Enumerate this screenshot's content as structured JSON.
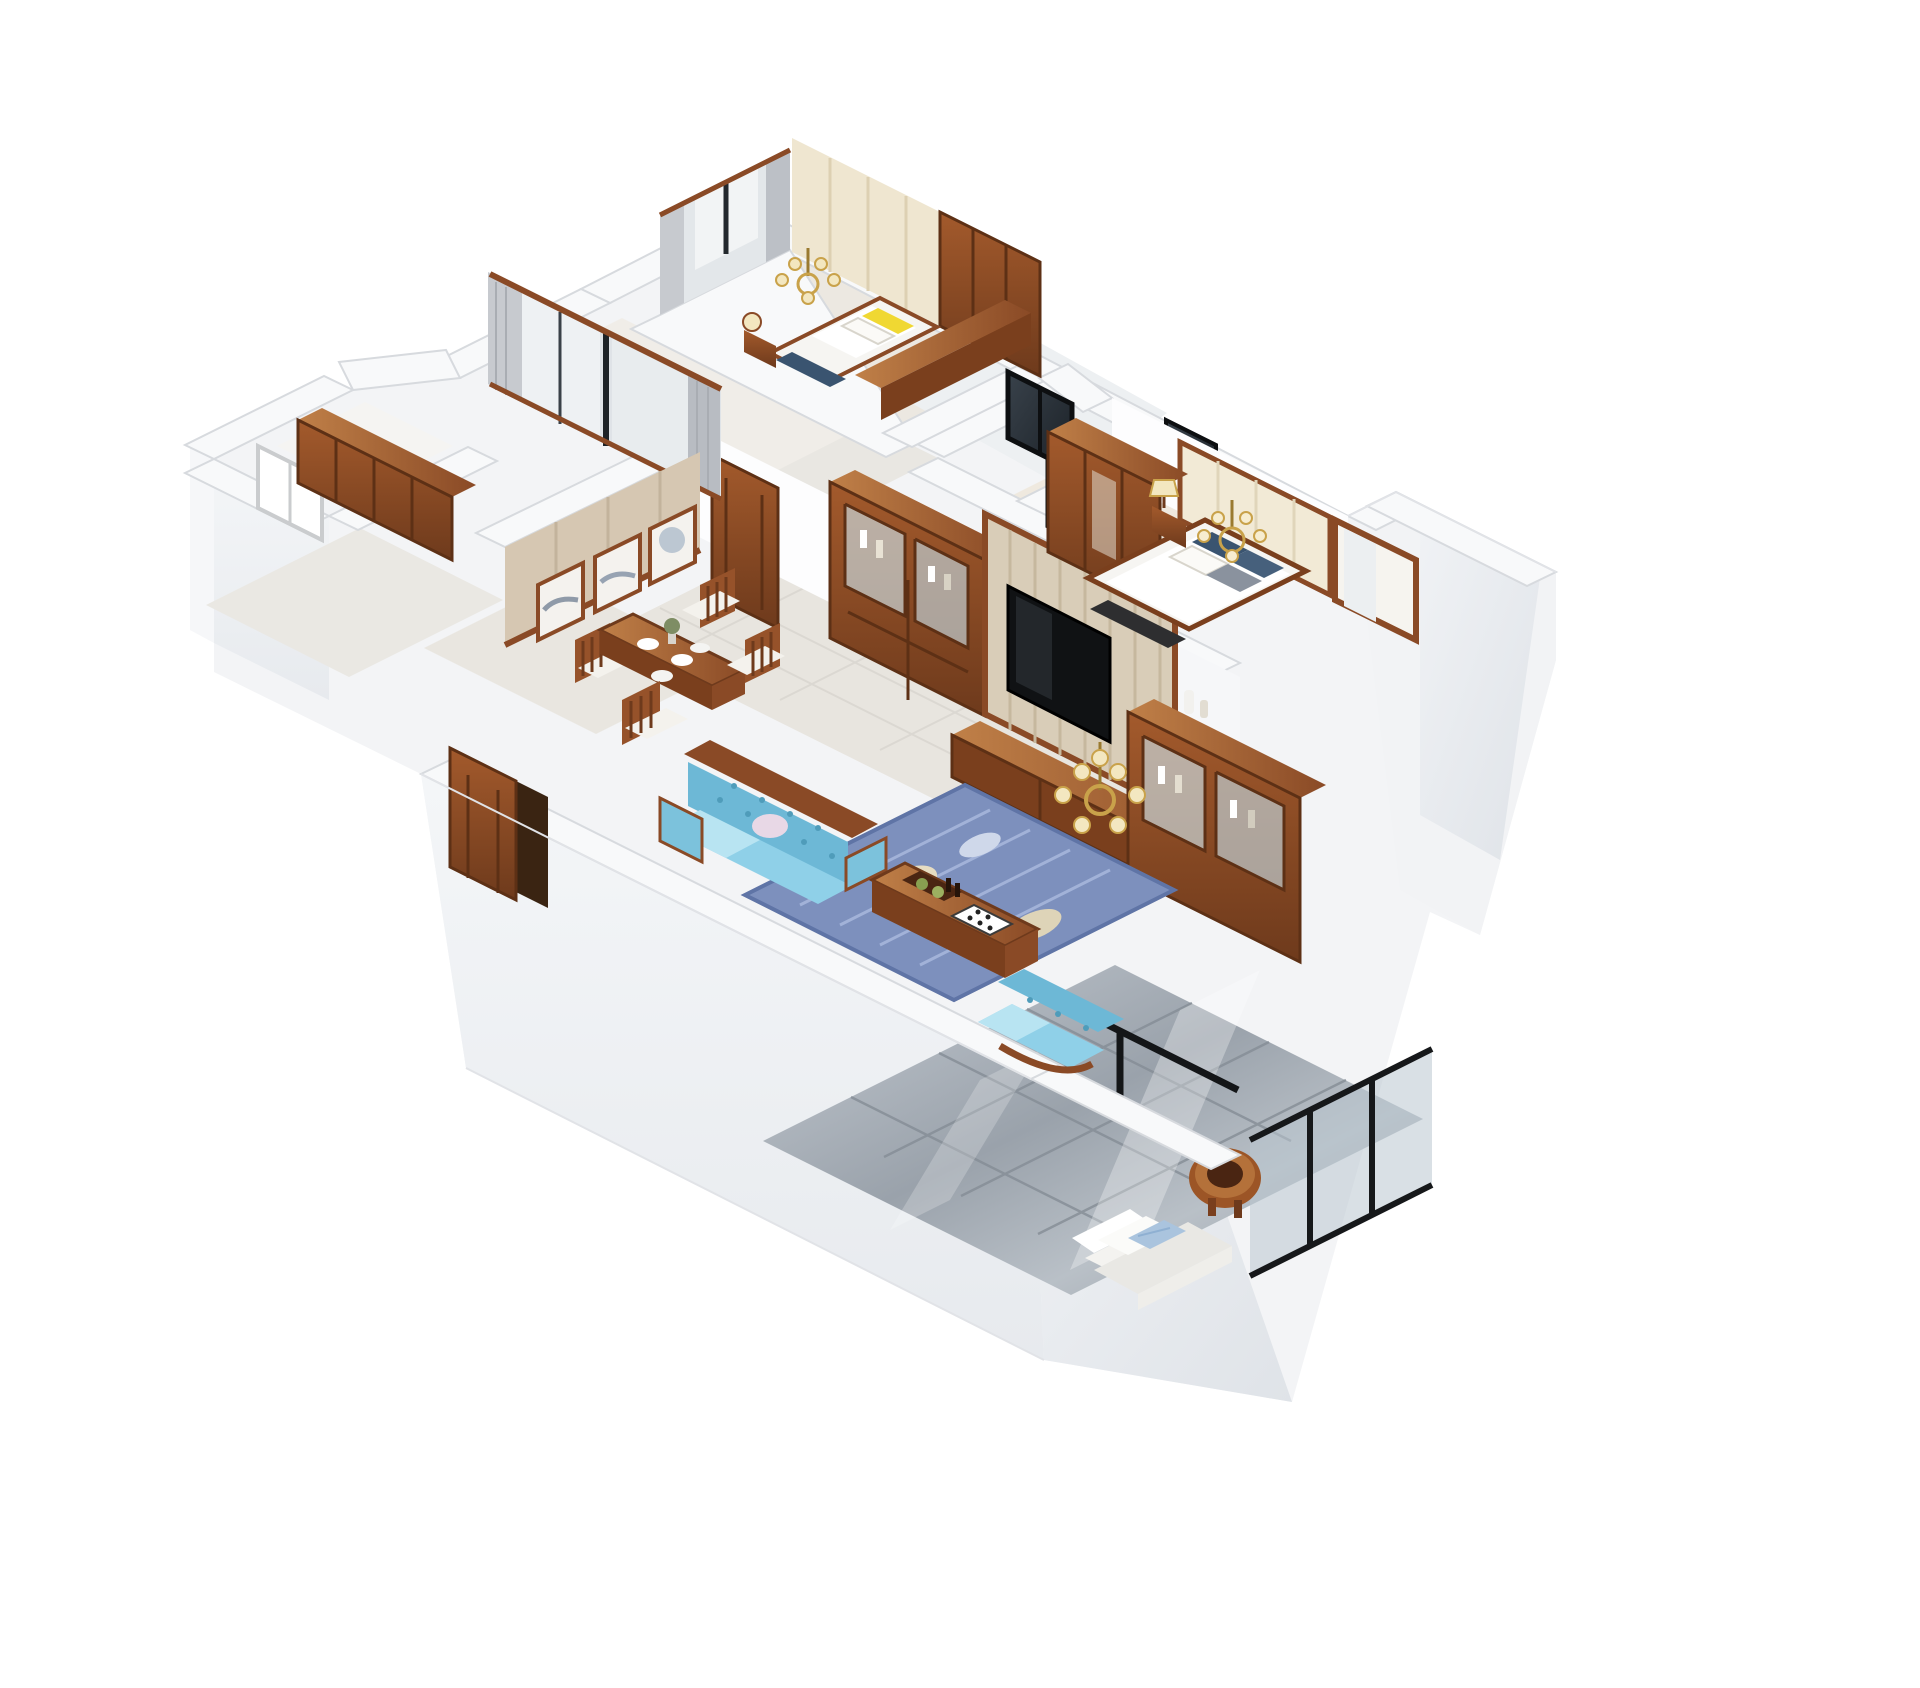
{
  "scene": {
    "type": "3d-floorplan-render",
    "view": "isometric dollhouse cutaway, white background",
    "description": "3D cutaway floor-plan rendering of an apartment with white walls, dark classical wood furniture, a light-blue sofa set in the living room, a dining room with three ink paintings, two bedrooms, glass-door bathrooms and a glossy-tiled balcony with a white lounge chair."
  },
  "palette": {
    "background": "#ffffff",
    "wall_top": "#f7f8fa",
    "wall_face_light": "#f1f3f5",
    "wall_face_shade": "#e6e9ed",
    "floor_marble": "#e8e5e0",
    "floor_warm": "#ece7df",
    "wood_dark": "#6e3a1c",
    "wood_mid": "#96522a",
    "wood_light": "#b4713a",
    "beige_wall": "#d6c7b2",
    "cream_panel": "#efe6d0",
    "sofa_blue": "#8fd0e8",
    "rug_blue": "#7d90bd",
    "pillow_yellow": "#f0d832",
    "pillow_navy": "#3a5470",
    "curtain_gray": "#c7cacf",
    "glass_dark": "#262d34",
    "balcony_tile": "#aab1b9",
    "brass": "#c9a24a",
    "tv_black": "#101214"
  },
  "rooms": [
    {
      "id": "bedroom-top",
      "label": "Bedroom (top)",
      "furniture": [
        "double bed with yellow and navy pillows",
        "wood nightstand",
        "brass chandelier with cream shades",
        "cream paneled wardrobe wall",
        "wood dresser counter",
        "gray curtains and window"
      ]
    },
    {
      "id": "bedroom-left",
      "label": "Bedroom (left)",
      "furniture": [
        "large wood-framed window",
        "gray curtains"
      ]
    },
    {
      "id": "side-room",
      "label": "Utility room",
      "furniture": [
        "wood wall cabinet",
        "bright window"
      ]
    },
    {
      "id": "dining-room",
      "label": "Dining room",
      "furniture": [
        "wood dining table",
        "four chairs with white cushions",
        "three framed ink paintings on tan wall",
        "open wood entry door"
      ]
    },
    {
      "id": "hallway",
      "label": "Hallway",
      "furniture": [
        "two paneled wood doors"
      ]
    },
    {
      "id": "bathrooms",
      "label": "Bathrooms",
      "furniture": [
        "black-framed dark glass sliding doors"
      ]
    },
    {
      "id": "living-room",
      "label": "Living room",
      "furniture": [
        "light-blue tufted sofa with wood crest",
        "light-blue armchair",
        "wood coffee table with chessboard and tray",
        "blue patterned rug",
        "brass chandelier",
        "TV backdrop wall with black television",
        "two glass display cabinets with bottles",
        "low wood TV console"
      ]
    },
    {
      "id": "master-bedroom",
      "label": "Master bedroom",
      "furniture": [
        "bed with white linens and navy pillows",
        "cream paneled headboard",
        "tall wood wardrobe",
        "nightstand with table lamp",
        "brass chandelier",
        "bay window",
        "wood door"
      ]
    },
    {
      "id": "balcony",
      "label": "Balcony",
      "furniture": [
        "white lounge chair with light-blue pillow",
        "round wood stool",
        "black-framed glass railing",
        "glossy gray floor tiles"
      ]
    }
  ]
}
